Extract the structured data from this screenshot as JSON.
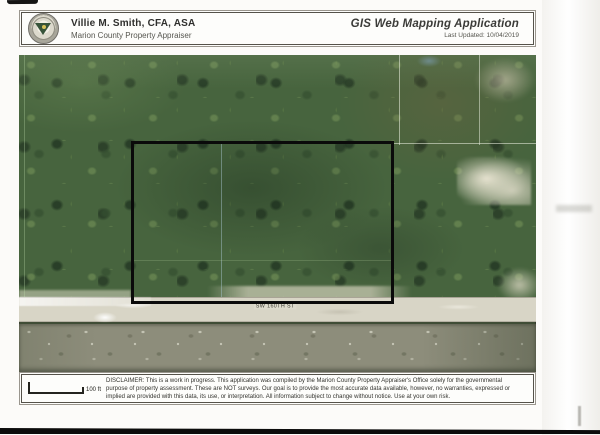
{
  "header": {
    "appraiser_name": "Villie M. Smith, CFA, ASA",
    "appraiser_title": "Marion County Property Appraiser",
    "app_title": "GIS Web Mapping Application",
    "last_updated": "Last Updated: 10/04/2019"
  },
  "map": {
    "road_label": "SW 160TH ST"
  },
  "footer": {
    "scale_label": "100 ft",
    "disclaimer": "DISCLAIMER: This is a work in progress. This application was compiled by the Marion County Property Appraiser's Office solely for the governmental purpose of property assessment. These are NOT surveys. Our goal is to provide the most accurate data available, however, no warranties, expressed or implied are provided with this data, its use, or interpretation. All information subject to change without notice. Use at your own risk."
  },
  "colors": {
    "forest_base": "#47643e",
    "forest_dark": "#2b4029",
    "forest_light": "#6e8e58",
    "road": "#d8d5c6",
    "scrub": "#8d8d7b",
    "sand": "#e8e4d2",
    "parcel_outline": "#0a0a0a",
    "panel_border": "#55524a"
  }
}
